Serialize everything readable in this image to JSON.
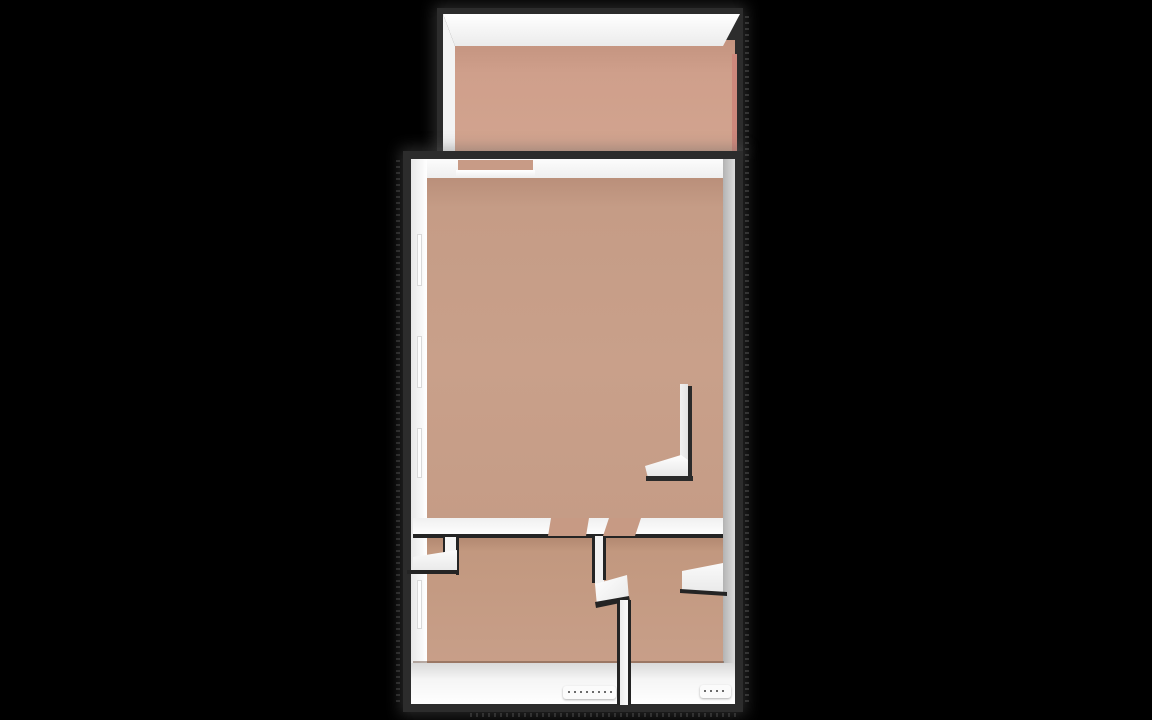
{
  "scene": {
    "kind": "3d-floorplan-render",
    "background_color": "#000000",
    "wall_dark_color": "#2c2c2c",
    "wall_white_color": "#f5f5f5",
    "floor_color": "#c59c86",
    "balcony_floor_color": "#d0a18c"
  },
  "floorplan": {
    "rooms": [
      {
        "name": "balcony",
        "position": "top"
      },
      {
        "name": "living-room",
        "position": "center-large"
      },
      {
        "name": "room-lower-left",
        "position": "bottom-left"
      },
      {
        "name": "room-lower-right",
        "position": "bottom-right"
      },
      {
        "name": "closet-nook",
        "position": "left-of-lower-left-room"
      }
    ],
    "shapes": [
      {
        "name": "balcony-outer-wall",
        "x": 437,
        "y": 8,
        "w": 306,
        "h": 144,
        "bg": "#2c2c2c",
        "shadow": "0 0 14px 3px rgba(95,95,95,0.45)"
      },
      {
        "name": "balcony-floor",
        "x": 455,
        "y": 40,
        "w": 280,
        "h": 111,
        "bg": "linear-gradient(180deg,#c3937f 0%,#cf9f8b 30%,#d2a48f 100%)"
      },
      {
        "name": "balcony-floor-edge",
        "x": 732,
        "y": 54,
        "w": 5,
        "h": 97,
        "bg": "#cd887c"
      },
      {
        "name": "balcony-back-wall-top",
        "points": [
          [
            443,
            14
          ],
          [
            740,
            14
          ],
          [
            723,
            46
          ],
          [
            455,
            46
          ]
        ],
        "bg": "linear-gradient(180deg,#ffffff 0%,#ebebeb 100%)"
      },
      {
        "name": "balcony-left-wall-top",
        "points": [
          [
            443,
            14
          ],
          [
            455,
            46
          ],
          [
            455,
            151
          ],
          [
            443,
            151
          ]
        ],
        "bg": "#f3f3f3"
      },
      {
        "name": "apartment-outer-wall",
        "x": 403,
        "y": 151,
        "w": 340,
        "h": 561,
        "bg": "#2c2c2c",
        "shadow": "0 0 14px 3px rgba(95,95,95,0.45)"
      },
      {
        "name": "living-room-floor",
        "x": 426,
        "y": 173,
        "w": 298,
        "h": 349,
        "bg": "linear-gradient(180deg,#b88d78 0%,#c59c86 10%,#c9a08a 55%,#c59c86 100%)"
      },
      {
        "name": "lower-rooms-floor",
        "x": 426,
        "y": 536,
        "w": 298,
        "h": 130,
        "bg": "linear-gradient(180deg,#b1876f 0%,#c2987f 12%,#c89f89 100%)"
      },
      {
        "name": "north-wall-face",
        "points": [
          [
            411,
            159
          ],
          [
            734,
            159
          ],
          [
            723,
            178
          ],
          [
            427,
            178
          ]
        ],
        "bg": "linear-gradient(180deg,#fcfcfc,#efefef)"
      },
      {
        "name": "balcony-door-opening",
        "x": 458,
        "y": 160,
        "w": 75,
        "h": 11,
        "bg": "#c89b86"
      },
      {
        "name": "balcony-door-sill",
        "x": 456,
        "y": 170,
        "w": 79,
        "h": 8,
        "bg": "linear-gradient(180deg,#ffffff,#ededed)"
      },
      {
        "name": "west-wall-face",
        "x": 411,
        "y": 159,
        "w": 16,
        "h": 506,
        "bg": "linear-gradient(90deg,#e8e8e8,#ffffff)"
      },
      {
        "name": "east-wall-face",
        "x": 723,
        "y": 159,
        "w": 12,
        "h": 506,
        "bg": "linear-gradient(90deg,#b3b3b3,#dcdcdc)"
      },
      {
        "name": "window-west-1",
        "x": 417,
        "y": 234,
        "w": 5,
        "h": 52,
        "bg": "#fdfdfd",
        "border": "1px solid #d9d9d9"
      },
      {
        "name": "window-west-2",
        "x": 417,
        "y": 336,
        "w": 5,
        "h": 52,
        "bg": "#fdfdfd",
        "border": "1px solid #d9d9d9"
      },
      {
        "name": "window-west-3",
        "x": 417,
        "y": 428,
        "w": 5,
        "h": 50,
        "bg": "#fdfdfd",
        "border": "1px solid #d9d9d9"
      },
      {
        "name": "window-west-4",
        "x": 417,
        "y": 580,
        "w": 5,
        "h": 49,
        "bg": "#fdfdfd",
        "border": "1px solid #d9d9d9"
      },
      {
        "name": "middle-wall-top",
        "x": 413,
        "y": 518,
        "w": 310,
        "h": 18,
        "bg": "linear-gradient(180deg,#f0f0f0,#ffffff)"
      },
      {
        "name": "middle-wall-south-edge",
        "x": 413,
        "y": 534,
        "w": 310,
        "h": 4,
        "bg": "#242424"
      },
      {
        "name": "door-opening-left",
        "points": [
          [
            551,
            518
          ],
          [
            589,
            518
          ],
          [
            586,
            536
          ],
          [
            548,
            536
          ]
        ],
        "bg": "#c79a84"
      },
      {
        "name": "door-opening-right",
        "points": [
          [
            609,
            518
          ],
          [
            641,
            518
          ],
          [
            635,
            536
          ],
          [
            603,
            536
          ]
        ],
        "bg": "#c79a84"
      },
      {
        "name": "closet-wall-vertical-top",
        "x": 445,
        "y": 537,
        "w": 12,
        "h": 36,
        "bg": "#f5f5f5"
      },
      {
        "name": "closet-wall-vertical-edge-left",
        "x": 443,
        "y": 537,
        "w": 2,
        "h": 20,
        "bg": "#242424"
      },
      {
        "name": "closet-wall-vertical-edge-right",
        "x": 456,
        "y": 537,
        "w": 3,
        "h": 38,
        "bg": "#242424"
      },
      {
        "name": "closet-wall-horizontal-top",
        "points": [
          [
            413,
            557
          ],
          [
            457,
            550
          ],
          [
            457,
            571
          ],
          [
            413,
            571
          ]
        ],
        "bg": "linear-gradient(180deg,#fbfbfb,#e9e9e9)"
      },
      {
        "name": "closet-wall-horizontal-edge",
        "x": 407,
        "y": 570,
        "w": 52,
        "h": 4,
        "bg": "#242424"
      },
      {
        "name": "divider-upper-edge-left",
        "x": 592,
        "y": 536,
        "w": 3,
        "h": 47,
        "bg": "#242424"
      },
      {
        "name": "divider-upper-top",
        "x": 595,
        "y": 536,
        "w": 9,
        "h": 48,
        "bg": "#f2f2f2"
      },
      {
        "name": "divider-upper-edge-right",
        "x": 603,
        "y": 536,
        "w": 3,
        "h": 44,
        "bg": "#242424"
      },
      {
        "name": "divider-jog-top",
        "points": [
          [
            595,
            584
          ],
          [
            627,
            575
          ],
          [
            629,
            599
          ],
          [
            597,
            606
          ]
        ],
        "bg": "linear-gradient(135deg,#ffffff,#e7e7e7)"
      },
      {
        "name": "divider-jog-edge",
        "points": [
          [
            595,
            602
          ],
          [
            629,
            596
          ],
          [
            630,
            601
          ],
          [
            596,
            608
          ]
        ],
        "bg": "#242424"
      },
      {
        "name": "south-wall-seam",
        "x": 413,
        "y": 661,
        "w": 311,
        "h": 2,
        "bg": "rgba(100,70,55,0.45)"
      },
      {
        "name": "south-wall-top",
        "x": 411,
        "y": 663,
        "w": 324,
        "h": 41,
        "bg": "linear-gradient(180deg,#d9d9d9 0%,#f5f5f5 40%,#ffffff 100%)"
      },
      {
        "name": "divider-lower-edge-left",
        "x": 617,
        "y": 600,
        "w": 3,
        "h": 105,
        "bg": "#242424"
      },
      {
        "name": "divider-lower-top",
        "x": 620,
        "y": 600,
        "w": 8,
        "h": 105,
        "bg": "linear-gradient(90deg,#ececec,#fafafa)"
      },
      {
        "name": "divider-lower-edge-right",
        "x": 628,
        "y": 600,
        "w": 3,
        "h": 105,
        "bg": "#242424"
      },
      {
        "name": "entry-wall-top",
        "points": [
          [
            682,
            571
          ],
          [
            723,
            563
          ],
          [
            723,
            592
          ],
          [
            682,
            592
          ]
        ],
        "bg": "linear-gradient(180deg,#fafafa,#eaeaea)"
      },
      {
        "name": "entry-wall-edge",
        "points": [
          [
            680,
            589
          ],
          [
            727,
            592
          ],
          [
            727,
            596
          ],
          [
            680,
            593
          ]
        ],
        "bg": "#242424"
      },
      {
        "name": "partition-vertical-top",
        "x": 680,
        "y": 384,
        "w": 8,
        "h": 94,
        "bg": "linear-gradient(90deg,#f2f2f2,#e3e3e3)"
      },
      {
        "name": "partition-vertical-shadow",
        "x": 688,
        "y": 386,
        "w": 4,
        "h": 94,
        "bg": "#2a2a2a"
      },
      {
        "name": "partition-foot-top",
        "points": [
          [
            645,
            466
          ],
          [
            681,
            455
          ],
          [
            688,
            460
          ],
          [
            688,
            477
          ],
          [
            648,
            478
          ]
        ],
        "bg": "linear-gradient(180deg,#ffffff,#e5e5e5)"
      },
      {
        "name": "partition-foot-edge",
        "x": 646,
        "y": 476,
        "w": 47,
        "h": 5,
        "bg": "#2a2a2a"
      },
      {
        "name": "dimension-tag-left",
        "x": 563,
        "y": 686,
        "w": 53,
        "h": 13,
        "bg": "#fbfbfb",
        "radius": 3,
        "shadow": "0 1px 2px rgba(0,0,0,0.3)"
      },
      {
        "name": "dimension-tag-left-dots",
        "x": 568,
        "y": 691,
        "w": 44,
        "h": 2,
        "bg": "repeating-linear-gradient(90deg,#6b6b6b 0 2px,transparent 2px 6px)"
      },
      {
        "name": "dimension-tag-right",
        "x": 700,
        "y": 685,
        "w": 31,
        "h": 13,
        "bg": "#fbfbfb",
        "radius": 3,
        "shadow": "0 1px 2px rgba(0,0,0,0.3)"
      },
      {
        "name": "dimension-tag-right-dots",
        "x": 704,
        "y": 690,
        "w": 24,
        "h": 2,
        "bg": "repeating-linear-gradient(90deg,#6b6b6b 0 2px,transparent 2px 6px)"
      },
      {
        "name": "shadow-dither-right",
        "x": 745,
        "y": 16,
        "w": 4,
        "h": 690,
        "bg": "repeating-linear-gradient(180deg,rgba(115,115,115,0.35) 0 2px,transparent 2px 6px)"
      },
      {
        "name": "shadow-dither-left",
        "x": 396,
        "y": 160,
        "w": 4,
        "h": 545,
        "bg": "repeating-linear-gradient(180deg,rgba(115,115,115,0.3) 0 2px,transparent 2px 6px)"
      },
      {
        "name": "shadow-dither-bottom",
        "x": 470,
        "y": 713,
        "w": 270,
        "h": 4,
        "bg": "repeating-linear-gradient(90deg,rgba(115,115,115,0.3) 0 2px,transparent 2px 6px)"
      }
    ]
  }
}
